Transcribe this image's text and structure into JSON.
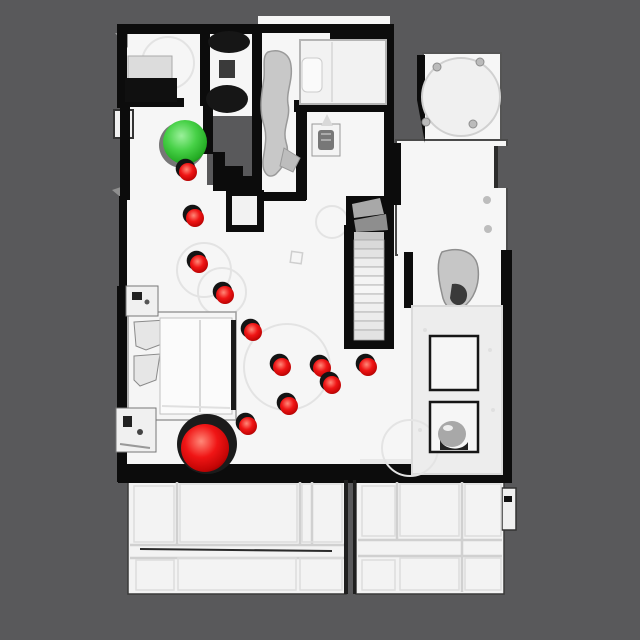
{
  "viewport": {
    "width": 640,
    "height": 640,
    "background_color": "#59595b"
  },
  "scene": {
    "kind": "top-down view of 3D-scanned house mesh with navigation path",
    "floor_color": "#f6f6f6",
    "wall_color": "#0c0c0c",
    "shadow_color": "#161616"
  },
  "path_markers": {
    "start": {
      "label": "start-sphere",
      "color": "#2fca2f",
      "highlight": "#9bf09b",
      "cx": 185,
      "cy": 142,
      "r": 22
    },
    "goal": {
      "label": "goal-sphere",
      "color": "#e51212",
      "highlight": "#ff8878",
      "cx": 205,
      "cy": 448,
      "r": 24,
      "ring_color": "#1b1b1b",
      "ring_r": 30
    },
    "waypoints": {
      "label": "waypoint-sphere",
      "color": "#e51212",
      "highlight": "#ff8878",
      "r": 9,
      "points": [
        {
          "cx": 188,
          "cy": 172
        },
        {
          "cx": 195,
          "cy": 218
        },
        {
          "cx": 199,
          "cy": 264
        },
        {
          "cx": 225,
          "cy": 295
        },
        {
          "cx": 253,
          "cy": 332
        },
        {
          "cx": 282,
          "cy": 367
        },
        {
          "cx": 322,
          "cy": 368
        },
        {
          "cx": 332,
          "cy": 385
        },
        {
          "cx": 368,
          "cy": 367
        },
        {
          "cx": 289,
          "cy": 406
        },
        {
          "cx": 248,
          "cy": 426
        }
      ]
    }
  }
}
